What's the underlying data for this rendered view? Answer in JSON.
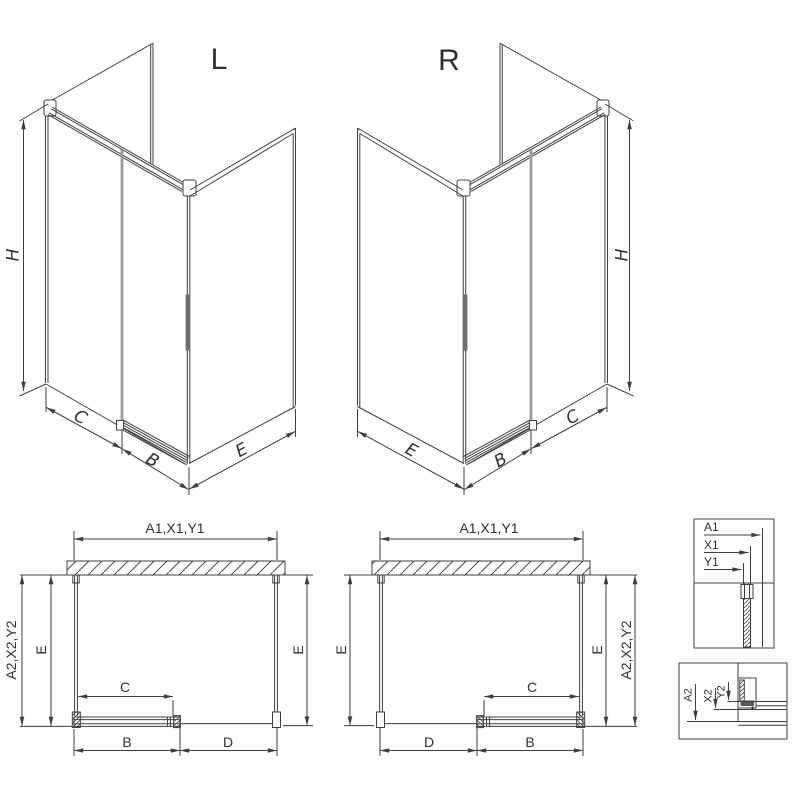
{
  "drawing": {
    "iso_left": {
      "title": "L",
      "dim_h": "H",
      "dim_c": "C",
      "dim_b": "B",
      "dim_e": "E"
    },
    "iso_right": {
      "title": "R",
      "dim_h": "H",
      "dim_c": "C",
      "dim_b": "B",
      "dim_e": "E"
    },
    "plan_left": {
      "dim_a1": "A1,X1,Y1",
      "dim_a2": "A2,X2,Y2",
      "dim_e_left": "E",
      "dim_e_right": "E",
      "dim_c": "C",
      "dim_b": "B",
      "dim_d": "D"
    },
    "plan_right": {
      "dim_a1": "A1,X1,Y1",
      "dim_a2": "A2,X2,Y2",
      "dim_e_left": "E",
      "dim_e_right": "E",
      "dim_c": "C",
      "dim_b": "B",
      "dim_d": "D"
    },
    "detail_top": {
      "dim_a1": "A1",
      "dim_x1": "X1",
      "dim_y1": "Y1"
    },
    "detail_bottom": {
      "dim_a2": "A2",
      "dim_x2": "X2",
      "dim_y2": "Y2"
    }
  },
  "colors": {
    "line": "#3f3f3f",
    "glass_edge": "#9a9a9a",
    "handle": "#6e6e6e",
    "background": "#ffffff"
  }
}
